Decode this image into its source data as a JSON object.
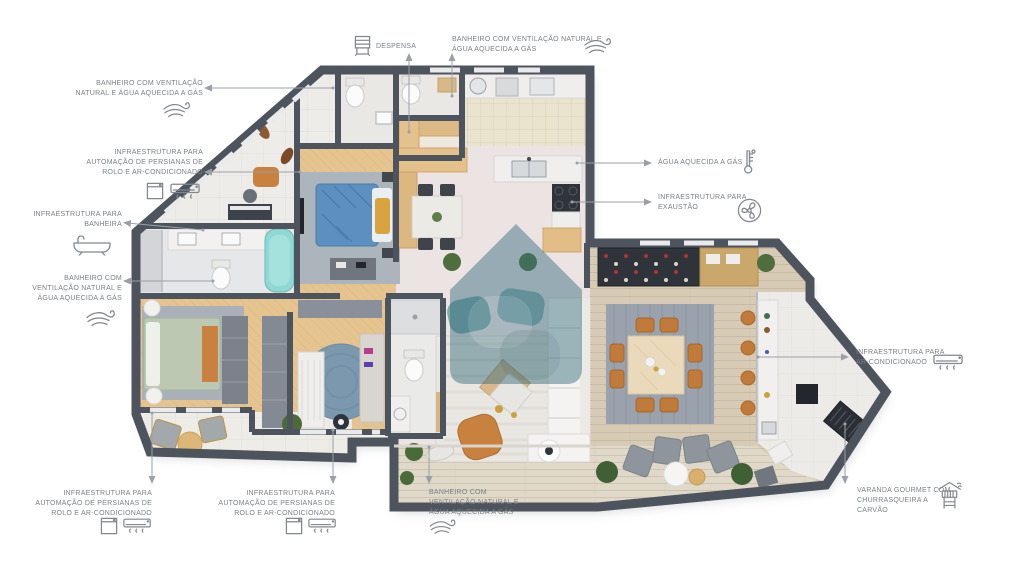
{
  "plan_type": "apartment floor plan with feature callouts",
  "colors": {
    "wall": "#4e545d",
    "wood_floor": "#e5c48f",
    "plank_floor": "#d8cbb6",
    "terrace_floor": "#e0d8c8",
    "kitchen_tile": "#eae3cd",
    "living_floor": "#ece3e3",
    "annotation_text": "#7a8087",
    "leader_line": "#9aa0a6",
    "watermark_teal": "#2e6678",
    "accent_orange": "#c0793a",
    "bed_blue": "#5d8fc0",
    "bathtub_teal": "#8fd8d3",
    "rug_gray": "#9aa3ad"
  },
  "annotations": {
    "despensa": {
      "icon": "pantry-cabinet-icon",
      "lines": [
        "DESPENSA"
      ]
    },
    "bathroom_top": {
      "icon": "wind-icon",
      "lines": [
        "BANHEIRO COM VENTILAÇÃO NATURAL E",
        "ÁGUA AQUECIDA A GÁS"
      ]
    },
    "bathroom_left_top": {
      "icon": "wind-icon",
      "lines": [
        "BANHEIRO COM VENTILAÇÃO",
        "NATURAL E ÁGUA AQUECIDA A GÁS"
      ]
    },
    "blinds_left": {
      "icons": [
        "roller-blind-icon",
        "ac-unit-icon"
      ],
      "lines": [
        "INFRAESTRUTURA PARA",
        "AUTOMAÇÃO DE PERSIANAS DE",
        "ROLO E AR-CONDICIONADO"
      ]
    },
    "bathtub": {
      "icon": "bathtub-icon",
      "lines": [
        "INFRAESTRUTURA PARA",
        "BANHEIRA"
      ]
    },
    "bathroom_left_bottom": {
      "icon": "wind-icon",
      "lines": [
        "BANHEIRO COM",
        "VENTILAÇÃO NATURAL E",
        "ÁGUA AQUECIDA A GÁS"
      ]
    },
    "gas_water": {
      "icon": "thermometer-icon",
      "lines": [
        "ÁGUA AQUECIDA A GÁS"
      ]
    },
    "exhaust": {
      "icon": "exhaust-fan-icon",
      "lines": [
        "INFRAESTRUTURA PARA",
        "EXAUSTÃO"
      ]
    },
    "ac_right": {
      "icon": "ac-unit-icon",
      "lines": [
        "INFRAESTRUTURA PARA",
        "AR-CONDICIONADO"
      ]
    },
    "blinds_bottom_left": {
      "icons": [
        "roller-blind-icon",
        "ac-unit-icon"
      ],
      "lines": [
        "INFRAESTRUTURA PARA",
        "AUTOMAÇÃO DE PERSIANAS DE",
        "ROLO E AR-CONDICIONADO"
      ]
    },
    "blinds_bottom_mid": {
      "icons": [
        "roller-blind-icon",
        "ac-unit-icon"
      ],
      "lines": [
        "INFRAESTRUTURA PARA",
        "AUTOMAÇÃO DE PERSIANAS DE",
        "ROLO E AR-CONDICIONADO"
      ]
    },
    "bathroom_bottom": {
      "icon": "wind-icon",
      "lines": [
        "BANHEIRO COM",
        "VENTILAÇÃO NATURAL E",
        "ÁGUA AQUECIDA A GÁS"
      ]
    },
    "varanda": {
      "icon": "charcoal-grill-icon",
      "lines": [
        "VARANDA GOURMET COM",
        "CHURRASQUEIRA A",
        "CARVÃO"
      ]
    }
  }
}
